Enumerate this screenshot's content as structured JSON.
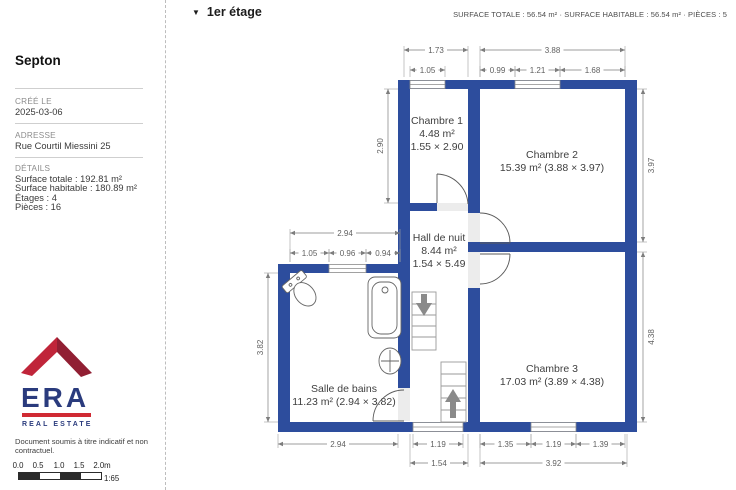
{
  "colors": {
    "wall": "#2d4d9d",
    "logo_red": "#c0253a",
    "logo_red_dark": "#911f33",
    "logo_navy": "#2a3b7d",
    "logo_bar": "#d02a33",
    "scalebar_dark": "#2b2b2b"
  },
  "sidebar": {
    "title": "Septon",
    "created_label": "CRÉÉ LE",
    "created_value": "2025-03-06",
    "address_label": "ADRESSE",
    "address_value": "Rue Courtil Miessini 25",
    "details_label": "DÉTAILS",
    "details": [
      "Surface totale : 192.81 m²",
      "Surface habitable : 180.89 m²",
      "Étages : 4",
      "Pièces : 16"
    ],
    "logo": {
      "brand": "ERA",
      "tagline": "REAL ESTATE"
    },
    "disclaimer": "Document soumis à titre indicatif et non contractuel.",
    "scalebar": {
      "ticks": [
        "0.0",
        "0.5",
        "1.0",
        "1.5",
        "2.0m"
      ],
      "ratio": "1:65"
    }
  },
  "header": {
    "floor_label": "1er étage",
    "stats": "SURFACE TOTALE : 56.54 m² · SURFACE HABITABLE : 56.54 m² · PIÈCES : 5"
  },
  "floorplan": {
    "rooms": [
      {
        "name": "Chambre 1",
        "area": "4.48 m²",
        "size": "1.55 × 2.90",
        "lines": [
          "Chambre 1",
          "4.48 m²",
          "1.55 × 2.90"
        ],
        "x": 437,
        "y": 124
      },
      {
        "name": "Chambre 2",
        "area": "15.39 m²",
        "size": "3.88 × 3.97",
        "lines": [
          "Chambre 2",
          "15.39 m² (3.88 × 3.97)"
        ],
        "x": 552,
        "y": 158
      },
      {
        "name": "Hall de nuit",
        "area": "8.44 m²",
        "size": "1.54 × 5.49",
        "lines": [
          "Hall de nuit",
          "8.44 m²",
          "1.54 × 5.49"
        ],
        "x": 439,
        "y": 241
      },
      {
        "name": "Chambre 3",
        "area": "17.03 m²",
        "size": "3.89 × 4.38",
        "lines": [
          "Chambre 3",
          "17.03 m² (3.89 × 4.38)"
        ],
        "x": 552,
        "y": 372
      },
      {
        "name": "Salle de bains",
        "area": "11.23 m²",
        "size": "2.94 × 3.82",
        "lines": [
          "Salle de bains",
          "11.23 m² (2.94 × 3.82)"
        ],
        "x": 344,
        "y": 392
      }
    ],
    "h_dims": [
      {
        "label": "1.73",
        "x1": 404,
        "x2": 468,
        "y": 50,
        "ext": 77
      },
      {
        "label": "3.88",
        "x1": 480,
        "x2": 625,
        "y": 50,
        "ext": 77
      },
      {
        "label": "1.05",
        "x1": 410,
        "x2": 445,
        "y": 70,
        "ext": 77
      },
      {
        "label": "0.99",
        "x1": 480,
        "x2": 515,
        "y": 70,
        "ext": 77
      },
      {
        "label": "1.21",
        "x1": 515,
        "x2": 560,
        "y": 70,
        "ext": 77
      },
      {
        "label": "1.68",
        "x1": 560,
        "x2": 625,
        "y": 70,
        "ext": 77
      },
      {
        "label": "2.94",
        "x1": 290,
        "x2": 400,
        "y": 233,
        "ext": 262
      },
      {
        "label": "1.05",
        "x1": 290,
        "x2": 329,
        "y": 253,
        "ext": 262
      },
      {
        "label": "0.96",
        "x1": 329,
        "x2": 366,
        "y": 253,
        "ext": 262
      },
      {
        "label": "0.94",
        "x1": 366,
        "x2": 400,
        "y": 253,
        "ext": 262
      },
      {
        "label": "2.94",
        "x1": 278,
        "x2": 398,
        "y": 444,
        "ext": 434
      },
      {
        "label": "1.19",
        "x1": 413,
        "x2": 463,
        "y": 444,
        "ext": 434
      },
      {
        "label": "1.35",
        "x1": 480,
        "x2": 531,
        "y": 444,
        "ext": 434
      },
      {
        "label": "1.19",
        "x1": 531,
        "x2": 576,
        "y": 444,
        "ext": 434
      },
      {
        "label": "1.39",
        "x1": 576,
        "x2": 625,
        "y": 444,
        "ext": 434
      },
      {
        "label": "1.54",
        "x1": 410,
        "x2": 468,
        "y": 463,
        "ext": 434
      },
      {
        "label": "3.92",
        "x1": 480,
        "x2": 627,
        "y": 463,
        "ext": 434
      }
    ],
    "v_dims": [
      {
        "label": "2.90",
        "y1": 89,
        "y2": 203,
        "x": 388,
        "ext": 398,
        "tside": -1
      },
      {
        "label": "3.82",
        "y1": 273,
        "y2": 422,
        "x": 268,
        "ext": 278,
        "tside": -1
      },
      {
        "label": "3.97",
        "y1": 89,
        "y2": 242,
        "x": 643,
        "ext": 637,
        "tside": 1
      },
      {
        "label": "4.38",
        "y1": 252,
        "y2": 422,
        "x": 643,
        "ext": 637,
        "tside": 1
      }
    ]
  }
}
